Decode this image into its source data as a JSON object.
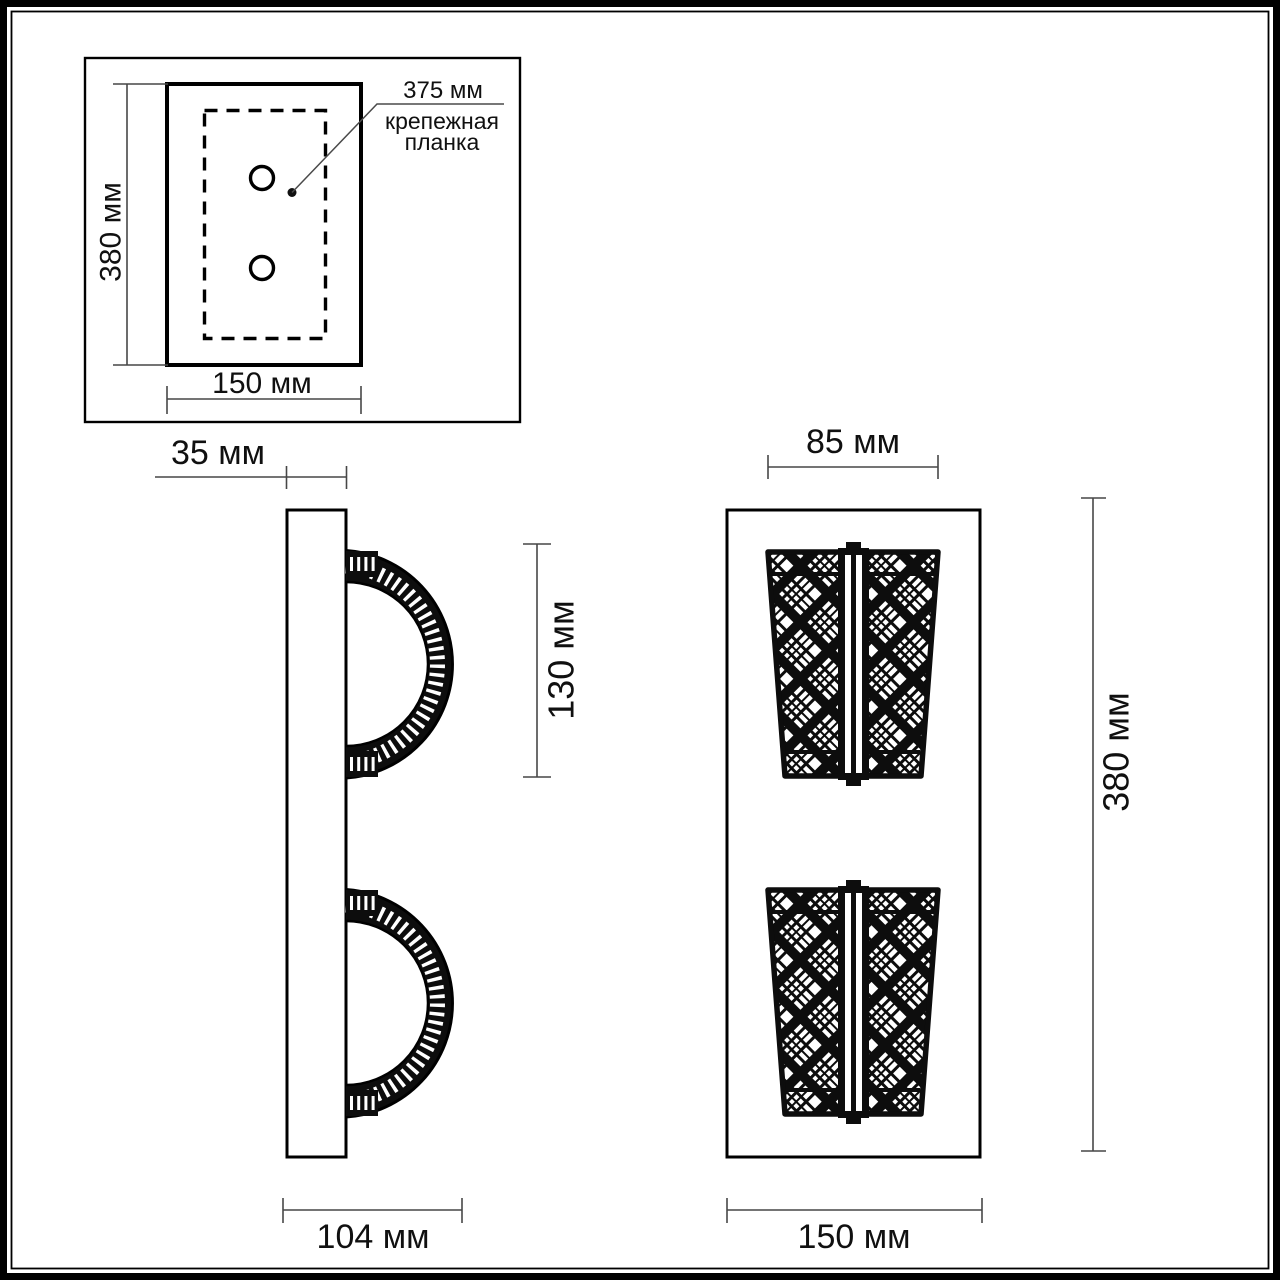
{
  "colors": {
    "ink": "#0d0d0d",
    "outline": "#000000",
    "dim_line": "#474747",
    "background": "#ffffff"
  },
  "detail_inset": {
    "height_label": "380 мм",
    "width_label": "150 мм",
    "bracket_length_label": "375 мм",
    "bracket_caption_line1": "крепежная",
    "bracket_caption_line2": "планка"
  },
  "side_view": {
    "depth_label": "35 мм",
    "shade_height_label": "130 мм",
    "total_depth_label": "104 мм"
  },
  "front_view": {
    "shade_width_label": "85 мм",
    "height_label": "380 мм",
    "width_label": "150 мм"
  }
}
